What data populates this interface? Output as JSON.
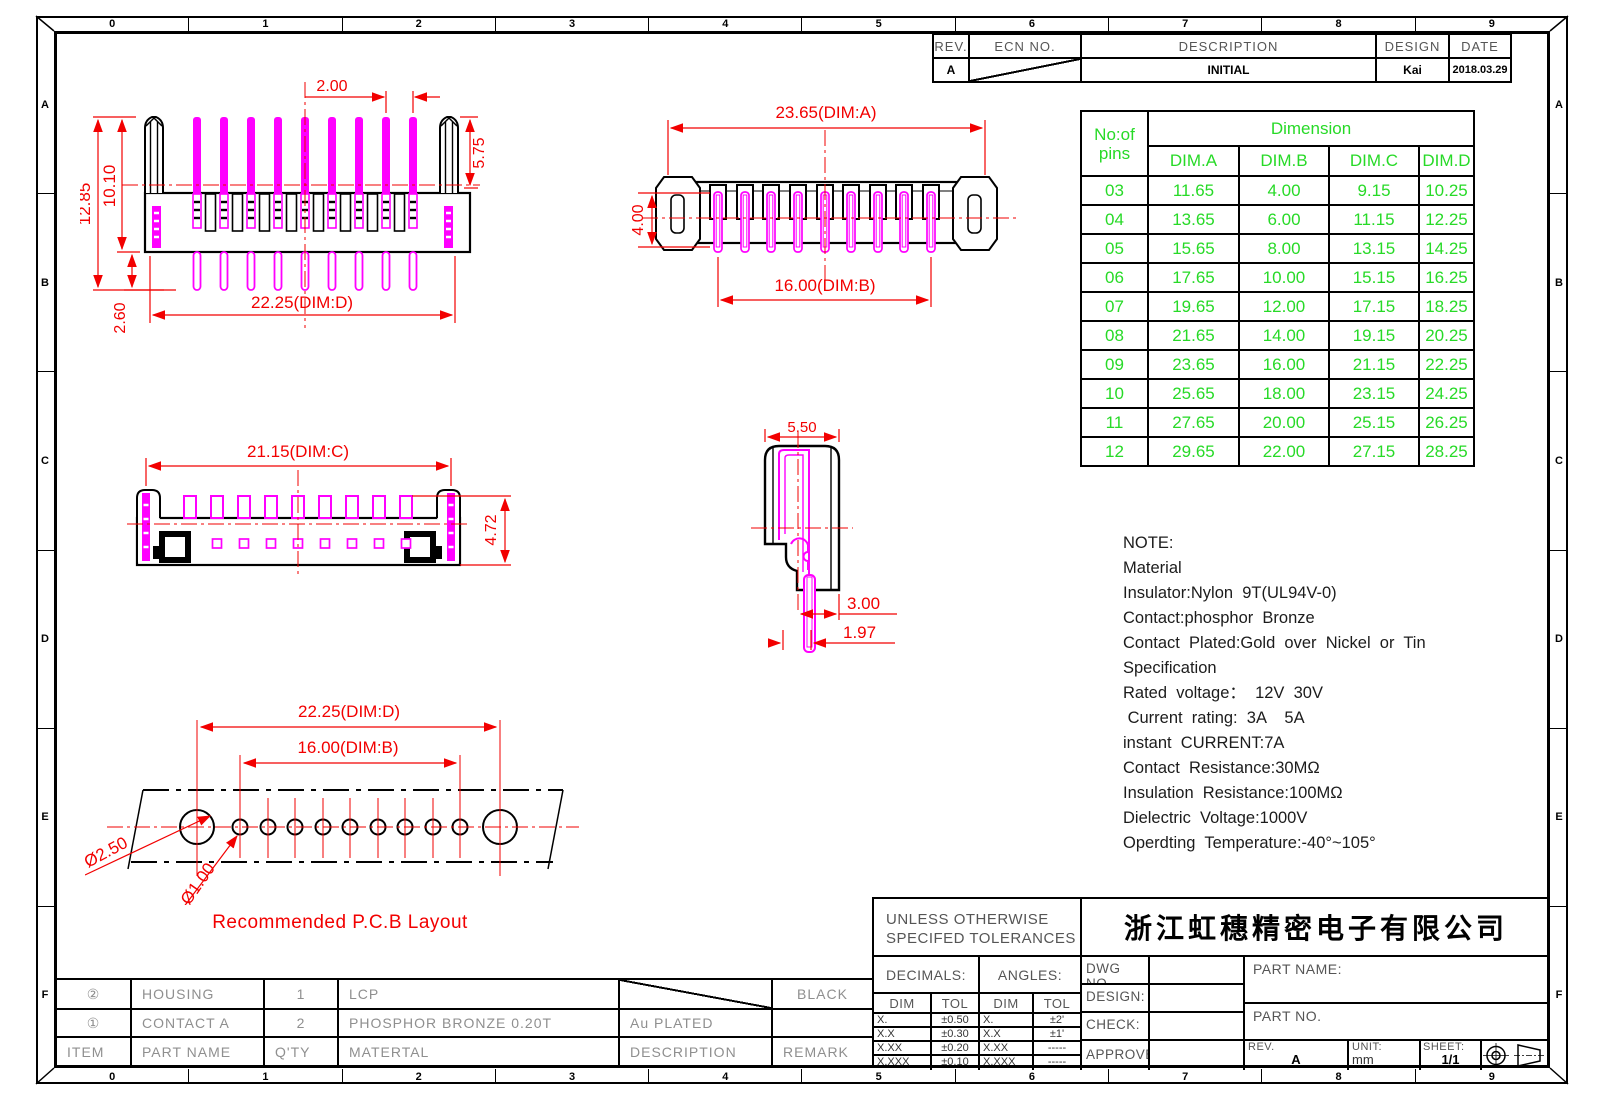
{
  "colors": {
    "red": "#f20000",
    "magenta": "#ff00ff",
    "green": "#27da27"
  },
  "frame": {
    "columns": [
      "0",
      "1",
      "2",
      "3",
      "4",
      "5",
      "6",
      "7",
      "8",
      "9"
    ],
    "rows": [
      "A",
      "B",
      "C",
      "D",
      "E",
      "F"
    ]
  },
  "revision_table": {
    "headers": [
      "REV.",
      "ECN NO.",
      "DESCRIPTION",
      "DESIGN",
      "DATE"
    ],
    "rows": [
      {
        "rev": "A",
        "description": "INITIAL",
        "design": "Kai",
        "date": "2018.03.29"
      }
    ]
  },
  "dimension_table": {
    "col1_line1": "No:of",
    "col1_line2": "pins",
    "group_header": "Dimension",
    "columns": [
      "DIM.A",
      "DIM.B",
      "DIM.C",
      "DIM.D"
    ],
    "rows": [
      {
        "pins": "03",
        "a": "11.65",
        "b": "4.00",
        "c": "9.15",
        "d": "10.25"
      },
      {
        "pins": "04",
        "a": "13.65",
        "b": "6.00",
        "c": "11.15",
        "d": "12.25"
      },
      {
        "pins": "05",
        "a": "15.65",
        "b": "8.00",
        "c": "13.15",
        "d": "14.25"
      },
      {
        "pins": "06",
        "a": "17.65",
        "b": "10.00",
        "c": "15.15",
        "d": "16.25"
      },
      {
        "pins": "07",
        "a": "19.65",
        "b": "12.00",
        "c": "17.15",
        "d": "18.25"
      },
      {
        "pins": "08",
        "a": "21.65",
        "b": "14.00",
        "c": "19.15",
        "d": "20.25"
      },
      {
        "pins": "09",
        "a": "23.65",
        "b": "16.00",
        "c": "21.15",
        "d": "22.25"
      },
      {
        "pins": "10",
        "a": "25.65",
        "b": "18.00",
        "c": "23.15",
        "d": "24.25"
      },
      {
        "pins": "11",
        "a": "27.65",
        "b": "20.00",
        "c": "25.15",
        "d": "26.25"
      },
      {
        "pins": "12",
        "a": "29.65",
        "b": "22.00",
        "c": "27.15",
        "d": "28.25"
      }
    ]
  },
  "notes": {
    "lines": [
      "NOTE:",
      "Material",
      "Insulator:Nylon  9T(UL94V-0)",
      "Contact:phosphor  Bronze",
      "Contact  Plated:Gold  over  Nickel  or  Tin",
      "Specification",
      "Rated  voltage：  12V  30V",
      " Current  rating:  3A    5A",
      "instant  CURRENT:7A",
      "Contact  Resistance:30MΩ",
      "Insulation  Resistance:100MΩ",
      "Dielectric  Voltage:1000V",
      "Operdting  Temperature:-40°~105°"
    ]
  },
  "views": {
    "front": {
      "dims": {
        "pitch": "2.00",
        "right_height": "5.75",
        "total_height": "12.85",
        "upper_height": "10.10",
        "lower_height": "2.60",
        "span": "22.25(DIM:D)"
      }
    },
    "top": {
      "dims": {
        "overall": "23.65(DIM:A)",
        "depth": "4.00",
        "pin_span": "16.00(DIM:B)"
      }
    },
    "bottom": {
      "dims": {
        "span": "21.15(DIM:C)",
        "height": "4.72"
      }
    },
    "side": {
      "dims": {
        "width": "5.50",
        "offset": "3.00",
        "tip": "1.97"
      }
    },
    "pcb": {
      "dims": {
        "span_d": "22.25(DIM:D)",
        "span_b": "16.00(DIM:B)",
        "hole_big": "Ø2.50",
        "hole_small": "Ø1.00"
      },
      "caption": "Recommended  P.C.B  Layout"
    }
  },
  "parts_table": {
    "headers": [
      "ITEM",
      "PART NAME",
      "Q'TY",
      "MATERTAL",
      "DESCRIPTION",
      "REMARK"
    ],
    "rows": [
      {
        "item": "②",
        "part_name": "HOUSING",
        "qty": "1",
        "material": "LCP",
        "description": "",
        "remark": "BLACK"
      },
      {
        "item": "①",
        "part_name": "CONTACT A",
        "qty": "2",
        "material": "PHOSPHOR BRONZE 0.20T",
        "description": "Au PLATED",
        "remark": ""
      }
    ]
  },
  "title_block": {
    "tolerance_note_line1": "UNLESS OTHERWISE",
    "tolerance_note_line2": "SPECIFED TOLERANCES",
    "company": "浙江虹穗精密电子有限公司",
    "decimals_label": "DECIMALS:",
    "angles_label": "ANGLES:",
    "dim_col": "DIM",
    "tol_col": "TOL",
    "decimals": [
      [
        "X.",
        "±0.50"
      ],
      [
        "X.X",
        "±0.30"
      ],
      [
        "X.XX",
        "±0.20"
      ],
      [
        "X.XXX",
        "±0.10"
      ]
    ],
    "angles": [
      [
        "X.",
        "±2'"
      ],
      [
        "X.X",
        "±1'"
      ],
      [
        "X.XX",
        "-----"
      ],
      [
        "X.XXX",
        "-----"
      ]
    ],
    "fields": {
      "dwg_no": "DWG NO.",
      "design": "DESIGN:",
      "check": "CHECK:",
      "approved": "APPROVED",
      "part_name": "PART NAME:",
      "part_no": "PART NO.",
      "rev_label": "REV.",
      "rev_value": "A",
      "unit_label": "UNIT:",
      "unit_value": "mm",
      "sheet_label": "SHEET:",
      "sheet_value": "1/1"
    }
  }
}
